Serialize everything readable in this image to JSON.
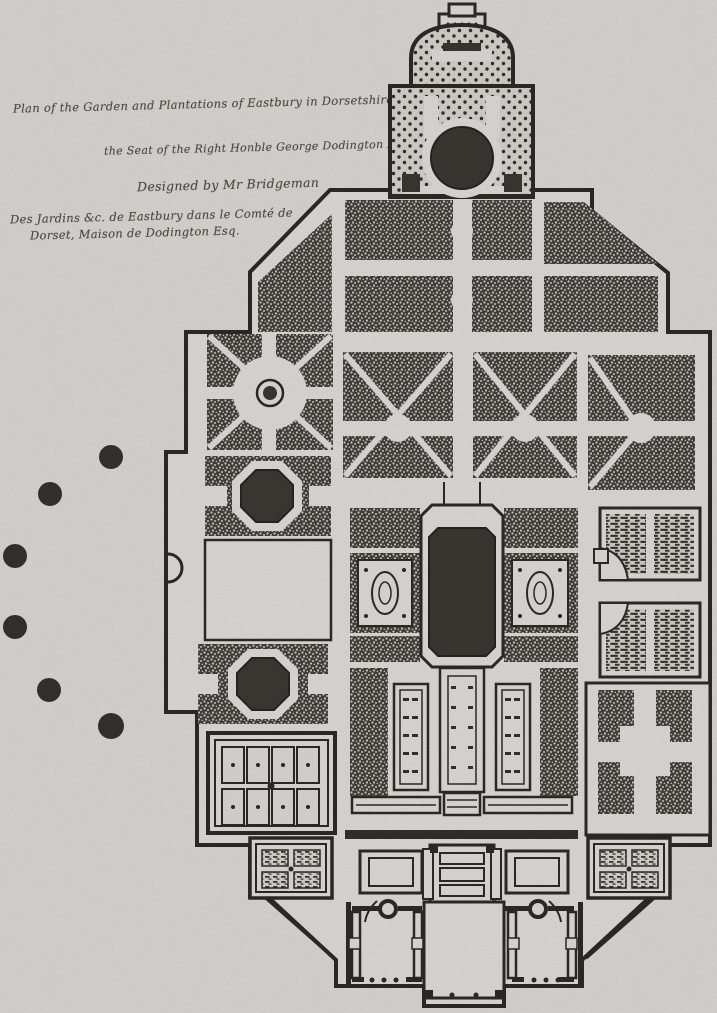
{
  "plate": {
    "type": "engraved-garden-plan",
    "title_lines": [
      "Plan of the Garden and Plantations of Eastbury in Dorsetshire",
      "the Seat of the Right Honble George Dodington Esqr",
      "Designed by Mr Bridgeman",
      "Des Jardins &c. de Eastbury dans le Comté de",
      "Dorset, Maison de Dodington Esq."
    ]
  },
  "colors": {
    "paper": "#d8d6d2",
    "plan_paper": "#dcdad6",
    "ink": "#26231f",
    "woodland": "#3e3a35",
    "water": "#34312d",
    "tree_clump": "#2e2b27"
  }
}
